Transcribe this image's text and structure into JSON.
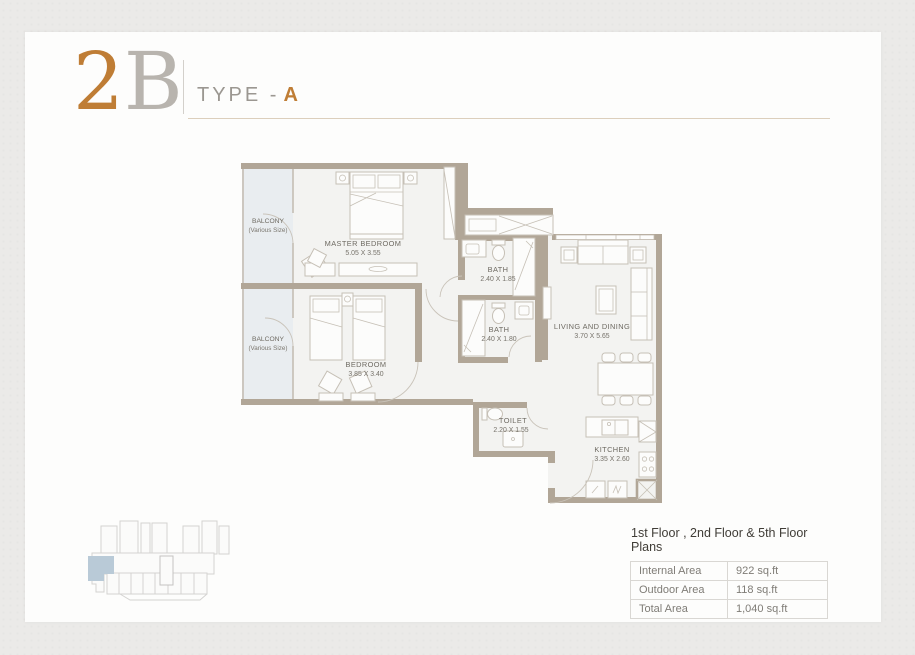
{
  "title": {
    "big_first": "2",
    "big_second": "B",
    "type_label": "TYPE -",
    "type_value": "A"
  },
  "rooms": {
    "balcony_top": {
      "name": "BALCONY",
      "size": "(Various Size)"
    },
    "balcony_bottom": {
      "name": "BALCONY",
      "size": "(Various Size)"
    },
    "master_bedroom": {
      "name": "MASTER BEDROOM",
      "size": "5.05 X 3.55"
    },
    "bedroom": {
      "name": "BEDROOM",
      "size": "3.85 X 3.40"
    },
    "bath_1": {
      "name": "BATH",
      "size": "2.40 X 1.85"
    },
    "bath_2": {
      "name": "BATH",
      "size": "2.40 X 1.80"
    },
    "living_dining": {
      "name": "LIVING AND DINING",
      "size": "3.70 X 5.65"
    },
    "toilet": {
      "name": "TOILET",
      "size": "2.20 X 1.55"
    },
    "kitchen": {
      "name": "KITCHEN",
      "size": "3.35 X 2.60"
    }
  },
  "footer": {
    "plans_title": "1st Floor , 2nd Floor & 5th Floor Plans",
    "table": {
      "rows": [
        {
          "label": "Internal Area",
          "value": "922 sq.ft"
        },
        {
          "label": "Outdoor Area",
          "value": "118 sq.ft"
        },
        {
          "label": "Total Area",
          "value": "1,040 sq.ft"
        }
      ]
    }
  },
  "colors": {
    "accent": "#bf7d35",
    "wall": "#b1a697",
    "key_plan_highlight": "#b9cad7",
    "page_background": "#ebeae8"
  }
}
